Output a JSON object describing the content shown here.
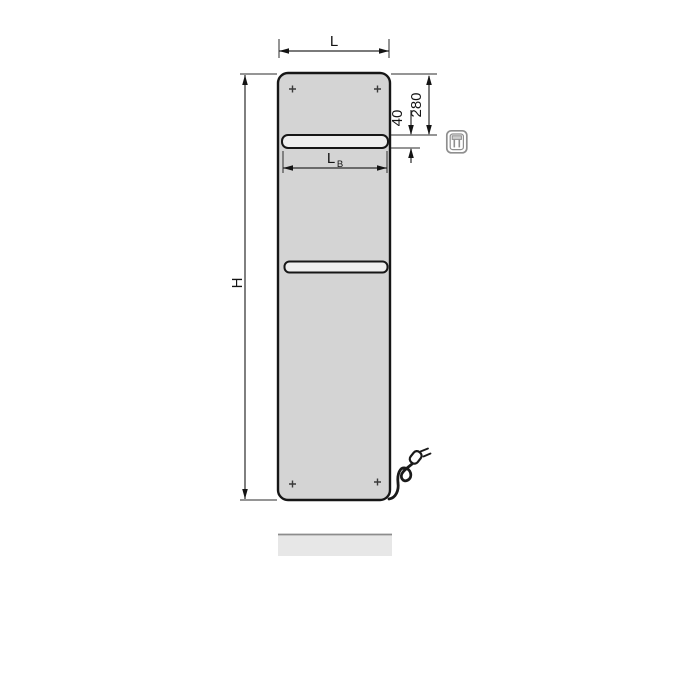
{
  "labels": {
    "overall_width": "L",
    "overall_height": "H",
    "bar_length_main": "L",
    "bar_length_subscript": "B",
    "top_to_bar_distance": "280",
    "bar_height": "40"
  },
  "icons": {
    "electric_plug": "electric-plug-icon"
  },
  "colors": {
    "background": "#ffffff",
    "panel_fill": "#d4d4d4",
    "panel_stroke": "#161616",
    "bar_fill": "#eeeeee",
    "dimension_stroke": "#2b2b2b",
    "icon_stroke": "#8f8f8f",
    "reflection_fill": "#e7e7e7",
    "reflection_edge": "#8d8d8d"
  }
}
